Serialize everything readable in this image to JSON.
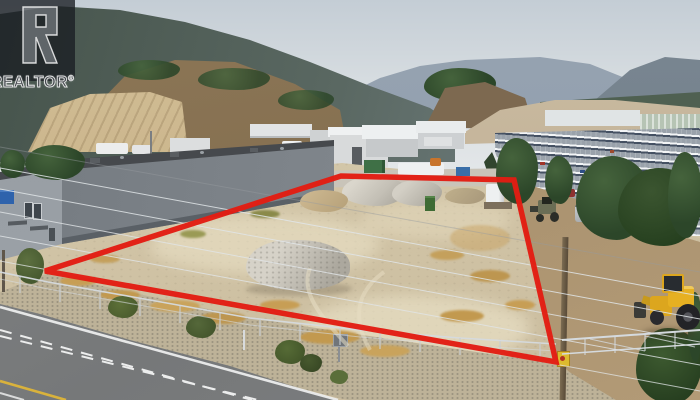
{
  "watermark": {
    "brand": "REALTOR",
    "registered": "®"
  },
  "colors": {
    "boundary_red": "#e21d13",
    "watermark_plate": "rgba(26,29,34,0.78)",
    "sky_top": "#c4cdd5",
    "sky_bottom": "#e4e7e9",
    "building_wall": "#7e848a",
    "building_face": "#9ca2a8",
    "building_sign_blue": "#2f63ac",
    "lot_sand": "#d4c7aa",
    "neighbor_dirt": "#a8906c",
    "road_asphalt": "#767879",
    "marking_white": "#eceded",
    "marking_yellow": "#d9b23c",
    "loader_yellow": "#dca61e",
    "gravel_gray": "#c4c0b6",
    "tree_green": "#35502e",
    "fence_silver": "#d5dade"
  }
}
